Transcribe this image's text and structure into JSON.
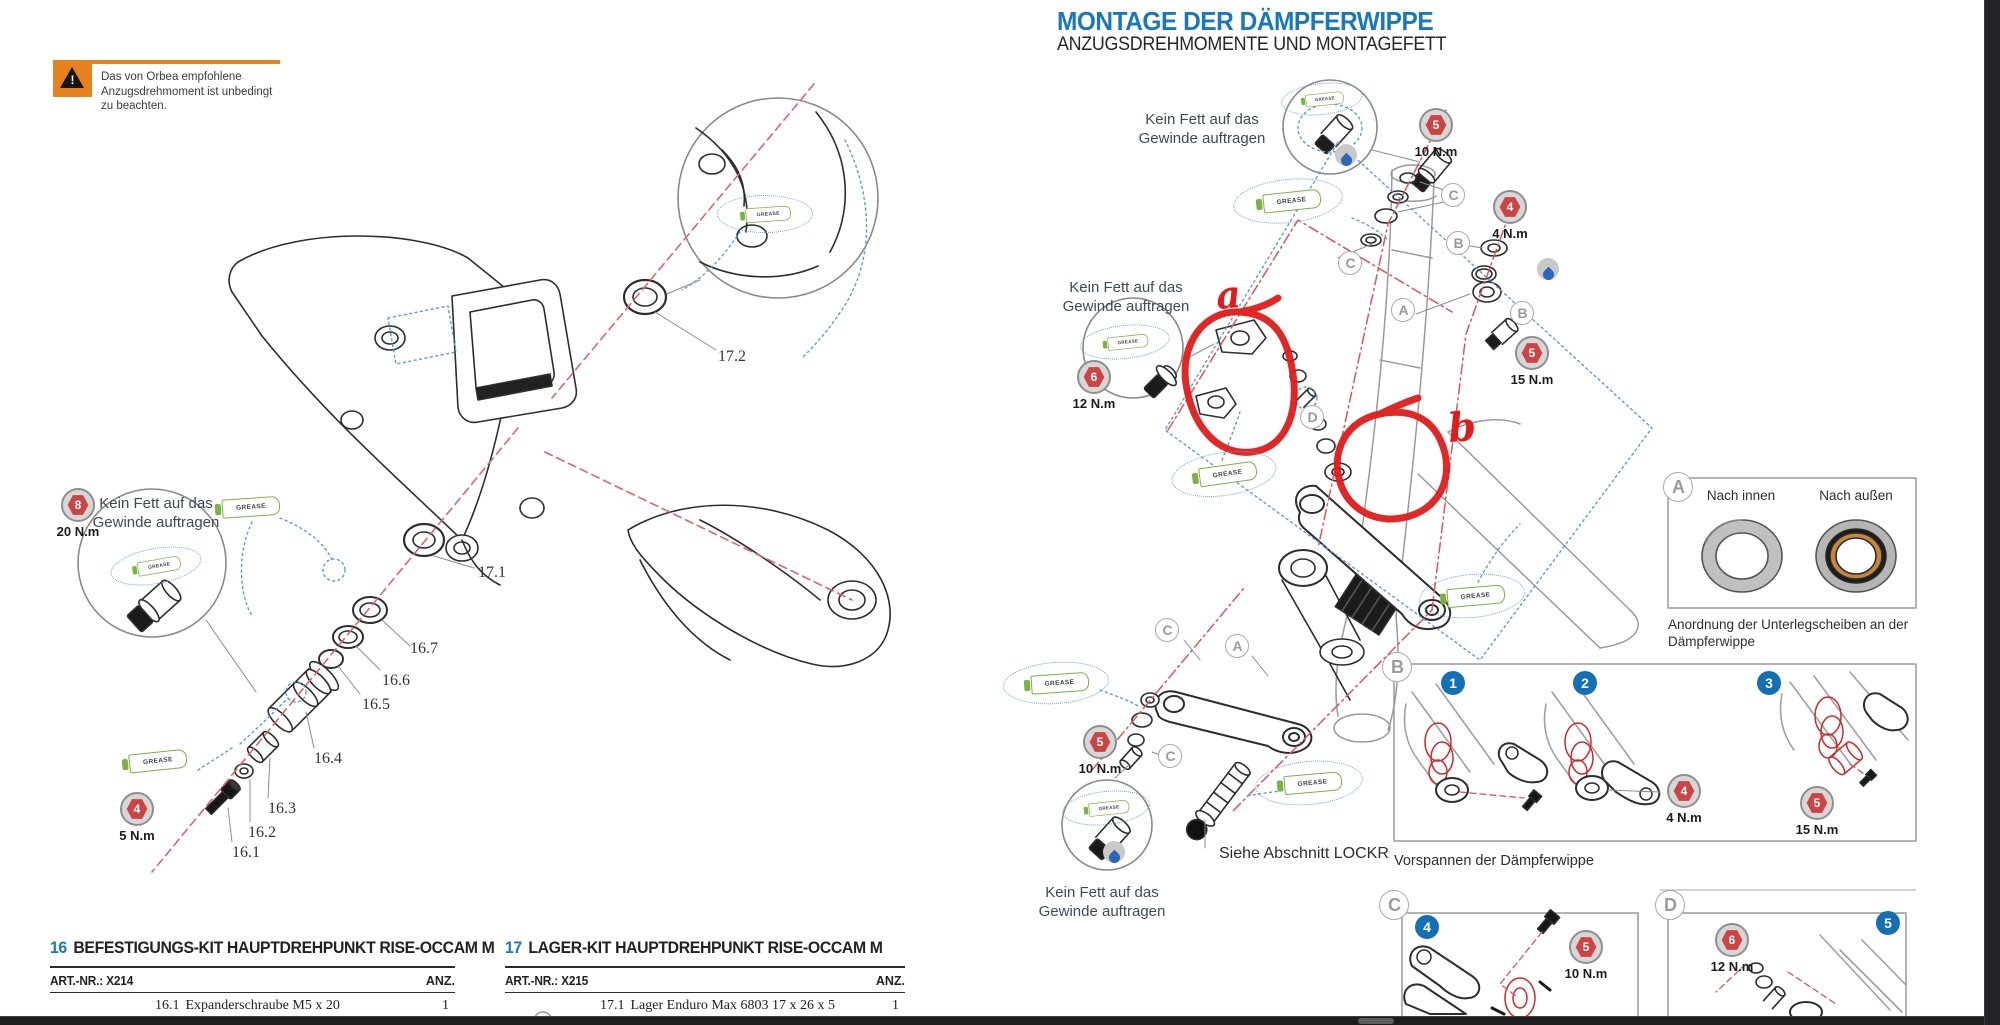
{
  "header": {
    "title": "MONTAGE DER DÄMPFERWIPPE",
    "subtitle": "ANZUGSDREHMOMENTE UND MONTAGEFETT"
  },
  "warning": {
    "text": "Das von Orbea empfohlene Anzugsdrehmoment ist unbedingt zu beachten.",
    "exclamation": "!"
  },
  "labels": {
    "no_grease_l1": "Kein Fett auf das",
    "no_grease_l2": "Gewinde auftragen",
    "grease": "GREASE",
    "see_lockr": "Siehe Abschnitt LOCKR",
    "preload_caption": "Vorspannen der Dämpferwippe",
    "washer_caption_l1": "Anordnung der Unterlegscheiben an der",
    "washer_caption_l2": "Dämpferwippe",
    "inward": "Nach innen",
    "outward": "Nach außen"
  },
  "badges": {
    "left_8": {
      "num": "8",
      "torque": "20 N.m"
    },
    "left_4": {
      "num": "4",
      "torque": "5 N.m"
    },
    "r_5_top": {
      "num": "5",
      "torque": "10 N.m"
    },
    "r_4": {
      "num": "4",
      "torque": "4 N.m"
    },
    "r_6": {
      "num": "6",
      "torque": "12 N.m"
    },
    "r_5_mid": {
      "num": "5",
      "torque": "15 N.m"
    },
    "r_5_low": {
      "num": "5",
      "torque": "10 N.m"
    },
    "b_4": {
      "num": "4",
      "torque": "4 N.m"
    },
    "b_5": {
      "num": "5",
      "torque": "15 N.m"
    },
    "c_5": {
      "num": "5",
      "torque": "10 N.m"
    },
    "d_6": {
      "num": "6",
      "torque": "12 N.m"
    }
  },
  "callouts": {
    "a": "A",
    "b": "B",
    "c": "C",
    "d": "D"
  },
  "steps": {
    "n1": "1",
    "n2": "2",
    "n3": "3",
    "n4": "4",
    "n5": "5"
  },
  "handwriting": {
    "a": "a",
    "b": "b"
  },
  "part_labels": {
    "p172": "17.2",
    "p171": "17.1",
    "p167": "16.7",
    "p166": "16.6",
    "p165": "16.5",
    "p164": "16.4",
    "p163": "16.3",
    "p162": "16.2",
    "p161": "16.1"
  },
  "tables": [
    {
      "kit_no": "16",
      "title": "BEFESTIGUNGS-KIT HAUPTDREHPUNKT RISE-OCCAM M",
      "art_nr": "ART.-NR.: X214",
      "qty_header": "ANZ.",
      "rows": [
        {
          "ref": "16.1",
          "name": "Expanderschraube M5 x 20",
          "qty": "1"
        }
      ]
    },
    {
      "kit_no": "17",
      "title": "LAGER-KIT HAUPTDREHPUNKT RISE-OCCAM M",
      "art_nr": "ART.-NR.: X215",
      "qty_header": "ANZ.",
      "rows": [
        {
          "ref": "17.1",
          "name": "Lager Enduro Max 6803 17 x 26 x 5",
          "qty": "1"
        }
      ]
    }
  ],
  "colors": {
    "accent_blue": "#1878be",
    "orange": "#e8821e",
    "badge_red": "#ce4343",
    "step_blue": "#1470b4",
    "grease_green": "#79b344",
    "annotation_red": "#e01b1b"
  }
}
